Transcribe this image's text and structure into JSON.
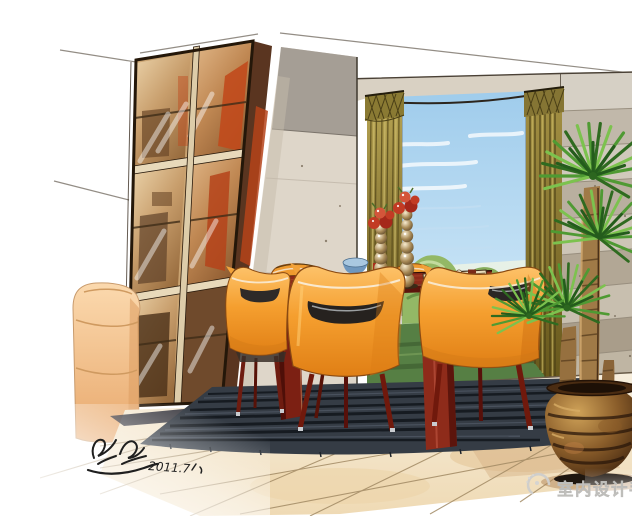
{
  "watermark": {
    "text": "室内设计手绘",
    "logo": "swirl-seal-logo",
    "color": "#c9c8c5"
  },
  "signature": {
    "date": "2011.7",
    "color": "#1f1f1f"
  },
  "palette": {
    "paper_white": "#ffffff",
    "chair_orange": "#f5a133",
    "table_mahogany": "#80231a",
    "curtain_olive": "#9c8a3f",
    "sky_blue": "#aed5ef",
    "foliage_green": "#4e9636",
    "rug_charcoal": "#353c45",
    "floor_cream": "#f3e6cc",
    "cabinet_amber": "#c49a66",
    "cabinet_interior_red": "#c14a1c",
    "wall_taupe": "#d8d0c3",
    "stone_wall_gray": "#c1b8aa",
    "pot_bronze": "#6e4a24",
    "sofa_peach": "#f2bd8c"
  },
  "scene": {
    "objects": [
      {
        "name": "ceiling-sketch-lines"
      },
      {
        "name": "display-cabinet"
      },
      {
        "name": "lounge-chair"
      },
      {
        "name": "center-wall-panel"
      },
      {
        "name": "bay-window"
      },
      {
        "name": "curtains"
      },
      {
        "name": "garden-view"
      },
      {
        "name": "stone-wall"
      },
      {
        "name": "tile-floor"
      },
      {
        "name": "area-rug"
      },
      {
        "name": "dining-table"
      },
      {
        "name": "dining-chairs"
      },
      {
        "name": "centerpiece-vases"
      },
      {
        "name": "blue-bowl"
      },
      {
        "name": "serving-tray"
      },
      {
        "name": "yucca-plant"
      },
      {
        "name": "glazed-planter"
      },
      {
        "name": "artist-signature"
      },
      {
        "name": "watermark"
      }
    ]
  }
}
